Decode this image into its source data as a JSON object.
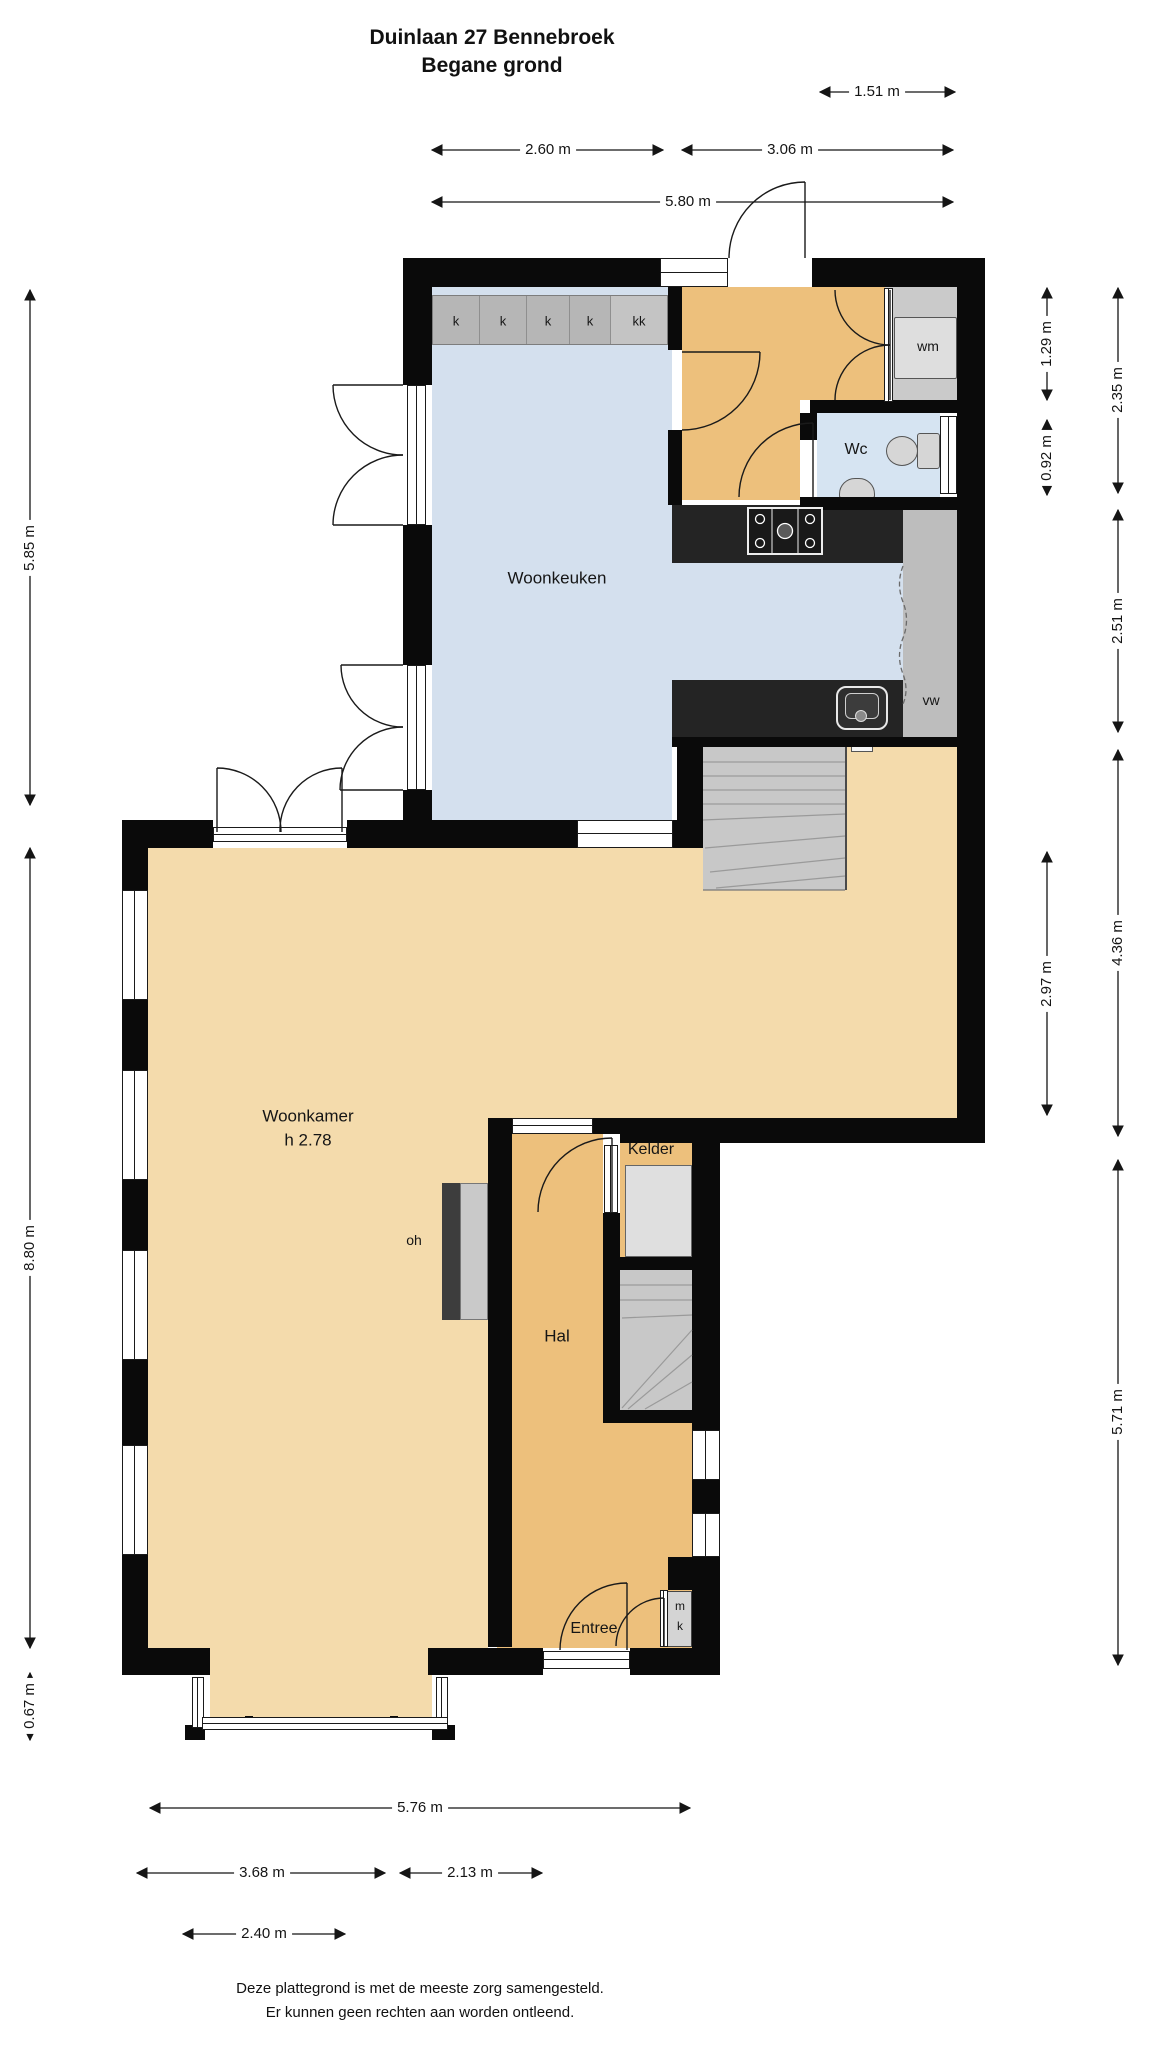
{
  "title": {
    "line1": "Duinlaan 27 Bennebroek",
    "line2": "Begane grond"
  },
  "rooms": {
    "woonkeuken": "Woonkeuken",
    "woonkamer": "Woonkamer",
    "woonkamer_height": "h 2.78",
    "hal": "Hal",
    "kelder": "Kelder",
    "entree": "Entree",
    "wc": "Wc"
  },
  "fixtures": {
    "washing_machine": "wm",
    "dishwasher": "vw",
    "fireplace": "oh",
    "meter_cupboard_line1": "m",
    "meter_cupboard_line2": "k",
    "cabinets": [
      "k",
      "k",
      "k",
      "k",
      "kk"
    ]
  },
  "dimensions": {
    "top_small": "1.51 m",
    "top_left": "2.60 m",
    "top_right": "3.06 m",
    "top_total": "5.80 m",
    "left_upper": "5.85 m",
    "left_main": "8.80 m",
    "left_bay": "0.67 m",
    "right_wm": "1.29 m",
    "right_wc": "0.92 m",
    "right_upper_total": "2.35 m",
    "right_kitchen": "2.51 m",
    "right_mid": "2.97 m",
    "right_mid_total": "4.36 m",
    "right_lower": "5.71 m",
    "bottom_total": "5.76 m",
    "bottom_left": "3.68 m",
    "bottom_right": "2.13 m",
    "bottom_bay": "2.40 m"
  },
  "footer": {
    "line1": "Deze plattegrond is met de meeste zorg samengesteld.",
    "line2": "Er kunnen geen rechten aan worden ontleend."
  },
  "colors": {
    "wall": "#0a0a0a",
    "kitchen_floor": "#d4e0ee",
    "wc_floor": "#d6e4f2",
    "hall_floor": "#edc07c",
    "living_floor": "#f4dbac",
    "stairs": "#c8c8c8",
    "counter": "#242424"
  }
}
